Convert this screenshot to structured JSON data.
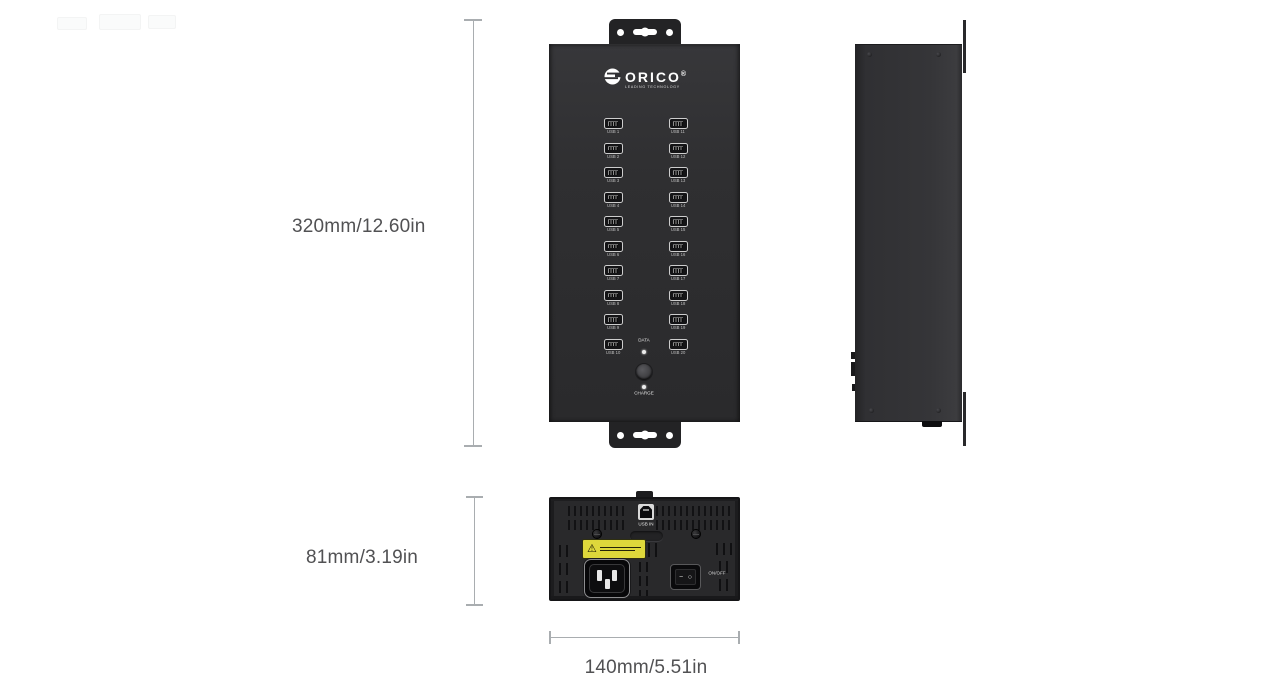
{
  "dimensions": {
    "front_height": "320mm/12.60in",
    "bottom_height": "81mm/3.19in",
    "bottom_width": "140mm/5.51in"
  },
  "front_view": {
    "brand": {
      "name": "ORICO",
      "registered": "®",
      "tagline": "LEADING TECHNOLOGY"
    },
    "usb_ports_left": [
      "USB 1",
      "USB 2",
      "USB 3",
      "USB 4",
      "USB 5",
      "USB 6",
      "USB 7",
      "USB 8",
      "USB 9",
      "USB 10"
    ],
    "usb_ports_right": [
      "USB 11",
      "USB 12",
      "USB 13",
      "USB 14",
      "USB 15",
      "USB 16",
      "USB 17",
      "USB 18",
      "USB 19",
      "USB 20"
    ],
    "indicators": {
      "data_label": "DATA",
      "charge_label": "CHARGE"
    }
  },
  "bottom_view": {
    "usb_in_label": "USB IN",
    "power_switch_label": "ON/OFF",
    "switch_on_symbol": "−",
    "switch_off_symbol": "○"
  },
  "colors": {
    "body_dark": "#2e2e30",
    "bracket": "#232325",
    "dimension_line": "#a9adb0",
    "dimension_text": "#515153",
    "warning_label": "#ded83b",
    "background": "#ffffff"
  }
}
